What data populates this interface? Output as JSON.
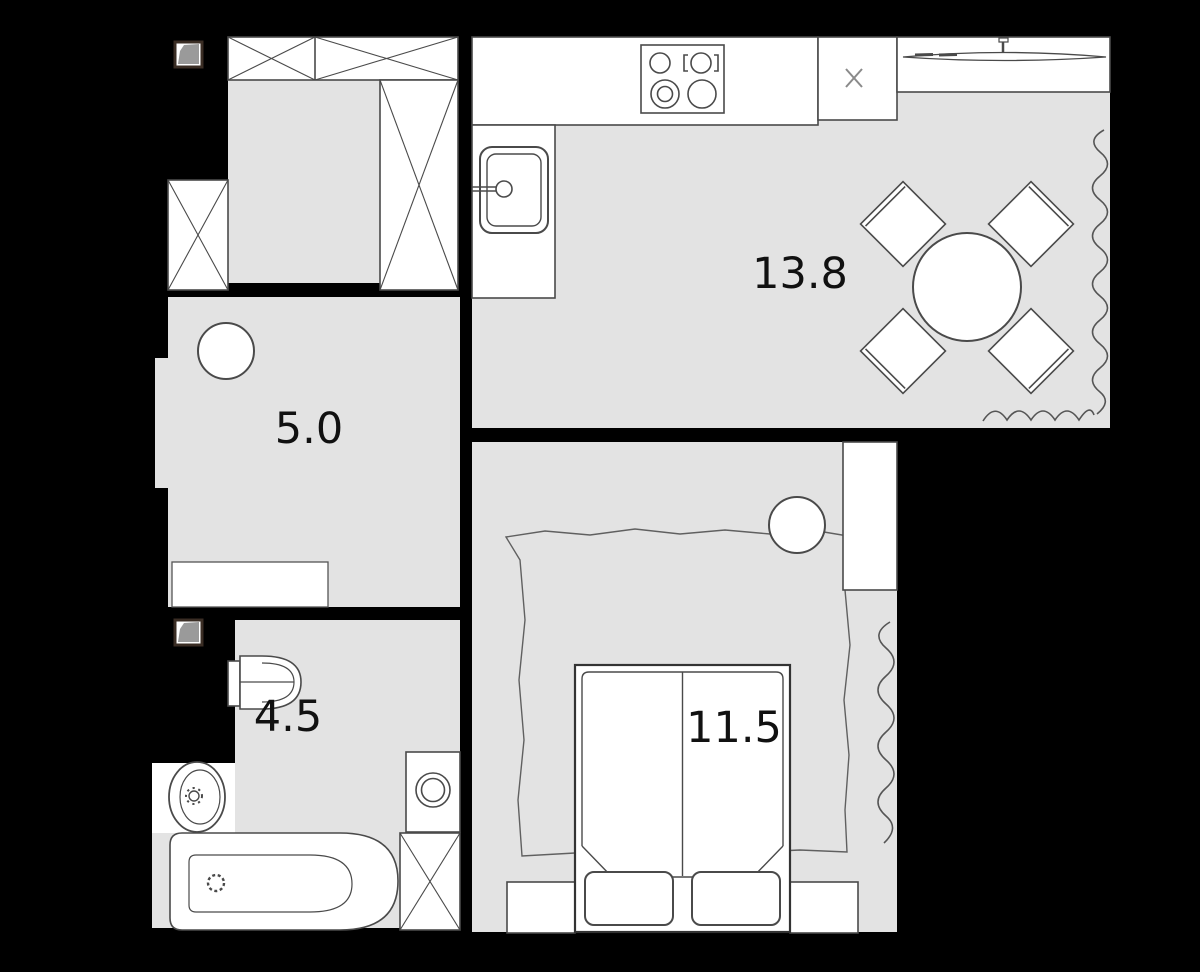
{
  "plan": {
    "title": "apartment-floor-plan",
    "rooms": {
      "kitchen_living": {
        "label": "kitchen-living-room",
        "area": "13.8"
      },
      "hallway": {
        "label": "hallway",
        "area": "5.0"
      },
      "bathroom": {
        "label": "bathroom",
        "area": "4.5"
      },
      "bedroom": {
        "label": "bedroom",
        "area": "11.5"
      }
    },
    "fixtures": {
      "hall": [
        "wardrobe-top",
        "wardrobe-tall",
        "wardrobe-left",
        "vent-icon",
        "stool",
        "cabinet"
      ],
      "kitchen": [
        "counter",
        "stove-4-burners",
        "sink-with-faucet",
        "fridge-x-box",
        "window-sill",
        "round-dining-table",
        "four-chairs",
        "curtain-squiggle-right",
        "curtain-squiggle-bottom"
      ],
      "bathroom": [
        "vent-icon",
        "toilet",
        "pedestal-sink",
        "washing-machine",
        "bathtub",
        "x-cabinet"
      ],
      "bedroom": [
        "double-bed",
        "two-pillows",
        "nightstand-left",
        "nightstand-right",
        "wardrobe",
        "round-side-table",
        "rug-sketch",
        "curtain-squiggle"
      ]
    },
    "colors": {
      "background": "#000000",
      "floor": "#e3e3e3",
      "fixture_fill": "#ffffff",
      "line": "#4a4a4a",
      "vent_fill": "#9a9a9a",
      "vent_border": "#3a2d24",
      "label_text": "#111111"
    }
  }
}
